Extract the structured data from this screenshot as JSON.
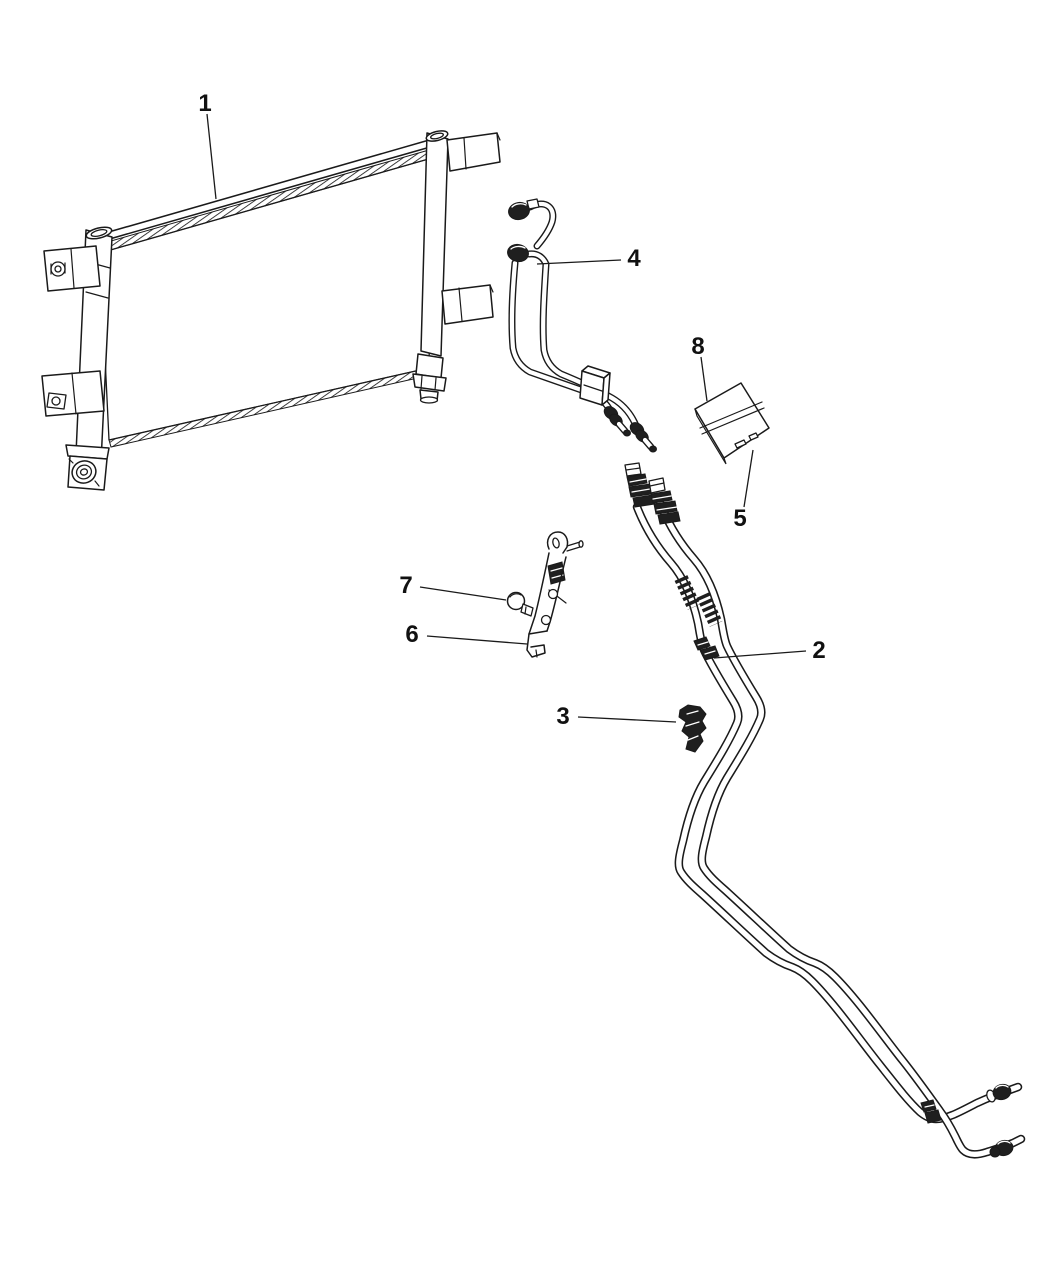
{
  "canvas": {
    "background": "#ffffff",
    "line_color": "#1a1a1a"
  },
  "callouts": [
    {
      "number": "1"
    },
    {
      "number": "2"
    },
    {
      "number": "3"
    },
    {
      "number": "4"
    },
    {
      "number": "5"
    },
    {
      "number": "6"
    },
    {
      "number": "7"
    },
    {
      "number": "8"
    }
  ]
}
